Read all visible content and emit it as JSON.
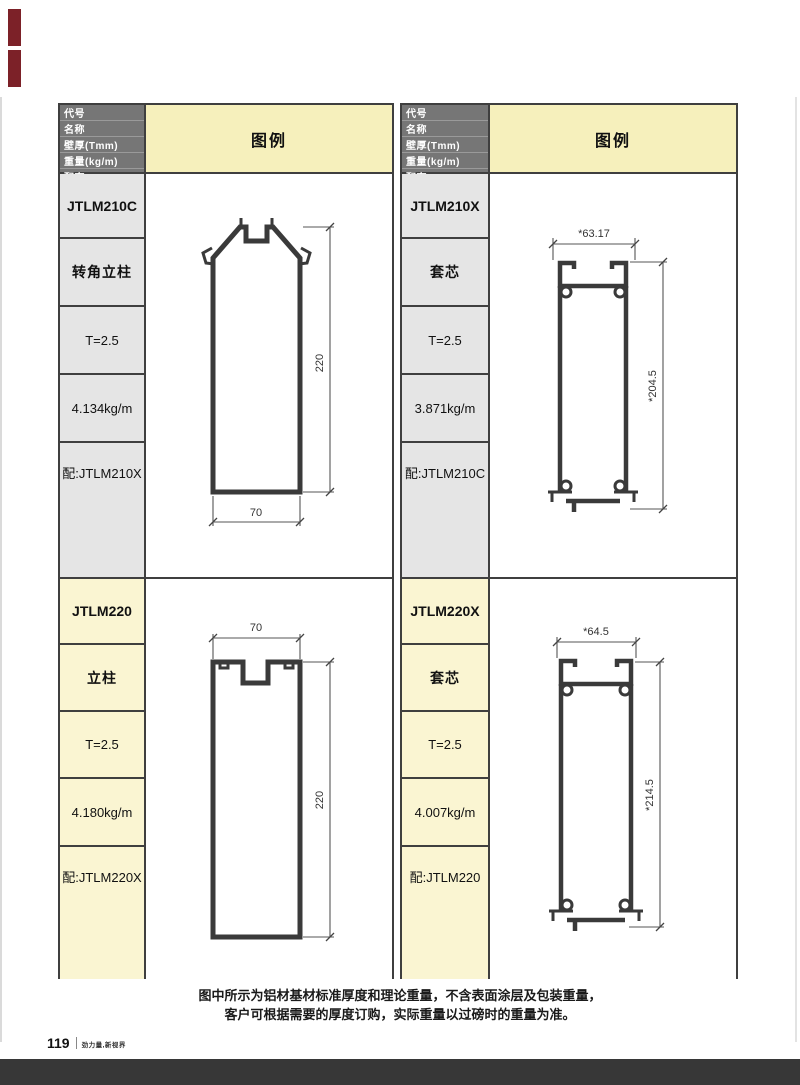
{
  "page": {
    "footer_note": {
      "line1": "图中所示为铝材基材标准厚度和理论重量，不含表面涂层及包装重量，",
      "line2": "客户可根据需要的厚度订购，实际重量以过磅时的重量为准。"
    },
    "page_number": "119",
    "brand_slogan": "劲力量,新视界"
  },
  "header": {
    "row_labels": [
      "代号",
      "名称",
      "壁厚(Tmm)",
      "重量(kg/m)",
      "配套"
    ],
    "legend_label": "图例"
  },
  "colors": {
    "header_bg": "#767676",
    "legend_bg": "#f6f0bc",
    "label_bg_gray": "#e5e5e5",
    "label_bg_cream": "#faf5d2",
    "table_border": "#3f3f3f",
    "profile_stroke": "#3a3a3a",
    "accent_red": "#7c2128",
    "bottom_bar": "#373737"
  },
  "profiles": [
    {
      "code": "JTLM210C",
      "name": "转角立柱",
      "thickness": "T=2.5",
      "weight": "4.134kg/m",
      "match": "配:JTLM210X",
      "dim_width": "70",
      "dim_height": "220"
    },
    {
      "code": "JTLM210X",
      "name": "套芯",
      "thickness": "T=2.5",
      "weight": "3.871kg/m",
      "match": "配:JTLM210C",
      "dim_width": "*63.17",
      "dim_height": "*204.5"
    },
    {
      "code": "JTLM220",
      "name": "立柱",
      "thickness": "T=2.5",
      "weight": "4.180kg/m",
      "match": "配:JTLM220X",
      "dim_width": "70",
      "dim_height": "220"
    },
    {
      "code": "JTLM220X",
      "name": "套芯",
      "thickness": "T=2.5",
      "weight": "4.007kg/m",
      "match": "配:JTLM220",
      "dim_width": "*64.5",
      "dim_height": "*214.5"
    }
  ]
}
